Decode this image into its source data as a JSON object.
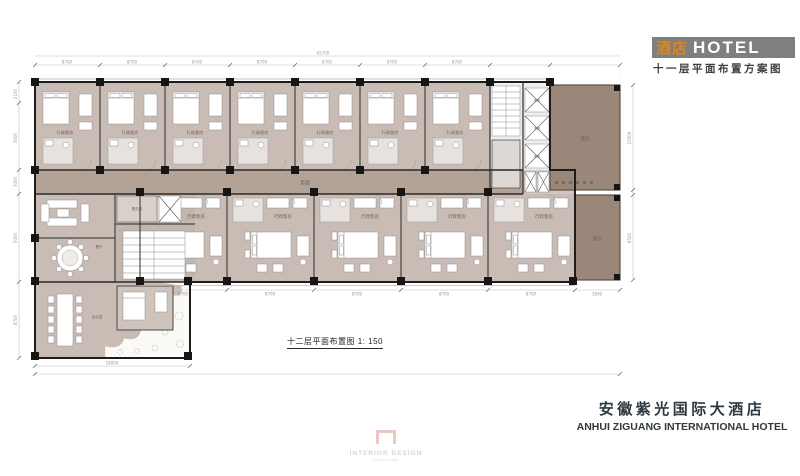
{
  "title_block": {
    "logo_cn": "酒店",
    "logo_en": "HOTEL",
    "scheme_title": "十一层平面布置方案图"
  },
  "caption": "十二层平面布置图 1: 150",
  "footer": {
    "hotel_name_cn": "安徽紫光国际大酒店",
    "hotel_name_en": "ANHUI ZIGUANG INTERNATIONAL HOTEL"
  },
  "watermark": {
    "brand": "INTERIOR DESIGN",
    "sub": "interior design"
  },
  "plan": {
    "labels": {
      "guest_room": "行政客房",
      "corridor": "走廊",
      "terrace": "露台",
      "elevator": "客梯",
      "service": "服务间",
      "dining": "餐厅",
      "meeting": "会议室"
    },
    "dimensions": {
      "total_top": "65700",
      "bay": "8700",
      "left": [
        "2100",
        "5000",
        "3000",
        "5000",
        "8700"
      ],
      "right": [
        "10500",
        "8500"
      ],
      "bottom_right_end": "3600",
      "wing_total": "18000"
    }
  },
  "colors": {
    "room_floor": "#c9bcb4",
    "corridor": "#b3a296",
    "terrace": "#9a8779",
    "wall": "#1f1d1b",
    "accent_orange": "#e0861c",
    "band_gray": "#7f7f7f"
  }
}
